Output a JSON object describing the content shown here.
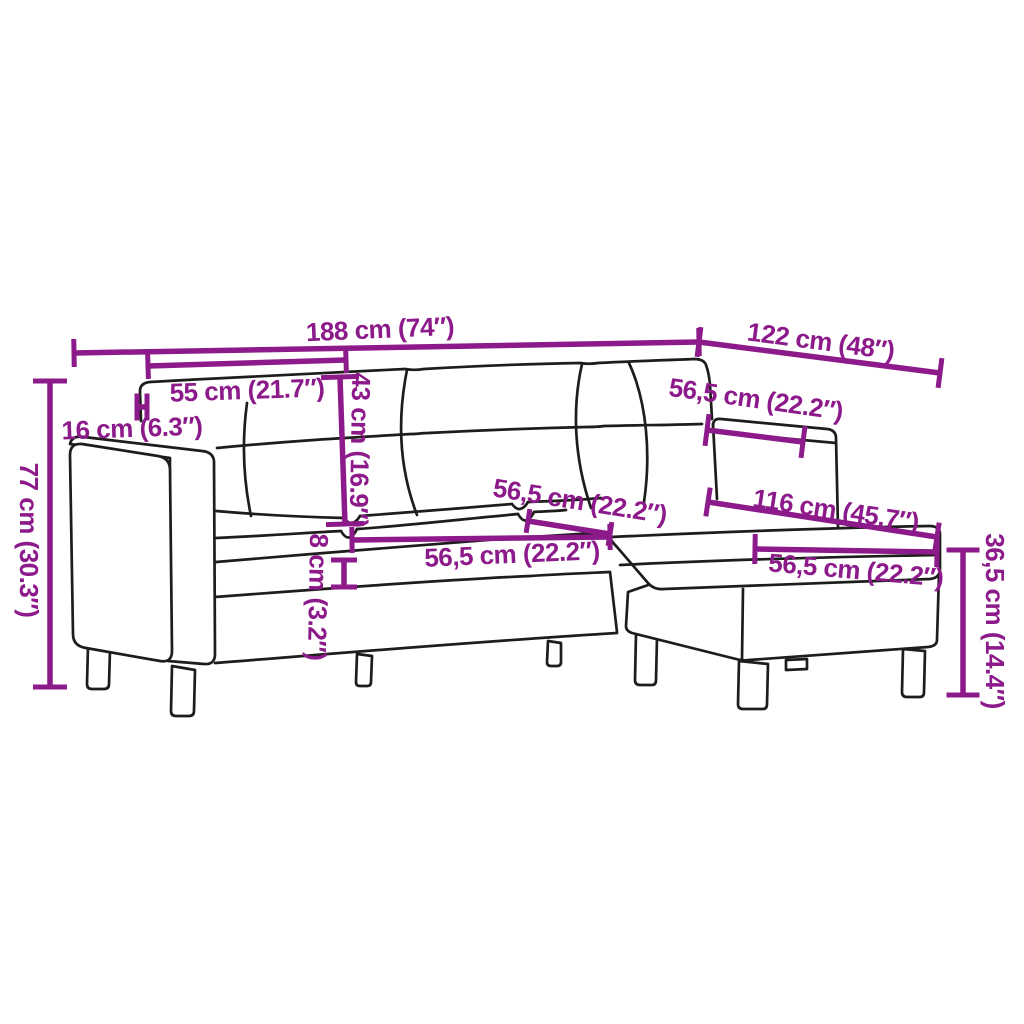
{
  "figure": {
    "type": "product-dimension-diagram",
    "subject": "sectional-sofa-with-footstool-line-drawing",
    "unit_primary": "cm",
    "unit_secondary": "inch",
    "font_size": 26
  },
  "colors": {
    "background": "#FFFFFF",
    "annotation": "#8C1A8A",
    "outline": "#1D1D1B"
  },
  "canvas": {
    "width": 1024,
    "height": 1024
  },
  "dimensions": [
    {
      "name": "overall-width",
      "label": "188 cm (74″)",
      "cm": "188",
      "inch": "74",
      "line": [
        74,
        353,
        699,
        342
      ],
      "tick": 28,
      "text": [
        380,
        329
      ],
      "rotate": -2.5
    },
    {
      "name": "overall-depth",
      "label": "122 cm (48″)",
      "cm": "122",
      "inch": "48",
      "line": [
        699,
        342,
        940,
        373
      ],
      "tick": 30,
      "text": [
        821,
        341
      ],
      "rotate": 7.5
    },
    {
      "name": "back-cushion-width",
      "label": "55 cm (21.7″)",
      "cm": "55",
      "inch": "21.7",
      "line": [
        148,
        366,
        346,
        360
      ],
      "tick": 26,
      "text": [
        247,
        390
      ],
      "rotate": -2
    },
    {
      "name": "backrest-height",
      "label": "43 cm (16.9″)",
      "cm": "43",
      "inch": "16.9",
      "line": [
        340,
        377,
        345,
        524
      ],
      "tick": 38,
      "text": [
        360,
        450
      ],
      "rotate": 91
    },
    {
      "name": "armrest-width",
      "label": "16 cm (6.3″)",
      "cm": "16",
      "inch": "6.3",
      "line": [
        137,
        407,
        147,
        407
      ],
      "tick": 27,
      "text": [
        132,
        428
      ],
      "rotate": -2
    },
    {
      "name": "overall-height",
      "label": "77 cm (30.3″)",
      "cm": "77",
      "inch": "30.3",
      "line": [
        50,
        381,
        50,
        687
      ],
      "tick": 34,
      "text": [
        29,
        540
      ],
      "rotate": 90
    },
    {
      "name": "right-backrest-width",
      "label": "56,5 cm (22.2″)",
      "cm": "56,5",
      "inch": "22.2",
      "line": [
        707,
        430,
        803,
        442
      ],
      "tick": 32,
      "text": [
        756,
        399
      ],
      "rotate": 8
    },
    {
      "name": "seat-depth",
      "label": "56,5 cm (22.2″)",
      "cm": "56,5",
      "inch": "22.2",
      "line": [
        528,
        521,
        610,
        534
      ],
      "tick": 24,
      "text": [
        580,
        501
      ],
      "rotate": 9
    },
    {
      "name": "seat-width",
      "label": "56,5 cm (22.2″)",
      "cm": "56,5",
      "inch": "22.2",
      "line": [
        352,
        540,
        610,
        537
      ],
      "tick": 26,
      "text": [
        512,
        554
      ],
      "rotate": -2.5
    },
    {
      "name": "seat-cushion-thickness",
      "label": "8 cm (3.2″)",
      "cm": "8",
      "inch": "3.2",
      "line": [
        344,
        560,
        344,
        587
      ],
      "tick": 26,
      "text": [
        318,
        597
      ],
      "rotate": 91
    },
    {
      "name": "footstool-length",
      "label": "116 cm (45.7″)",
      "cm": "116",
      "inch": "45.7",
      "line": [
        708,
        502,
        937,
        537
      ],
      "tick": 29,
      "text": [
        836,
        510
      ],
      "rotate": 8.5
    },
    {
      "name": "footstool-width",
      "label": "56,5 cm (22.2″)",
      "cm": "56,5",
      "inch": "22.2",
      "line": [
        755,
        549,
        937,
        552
      ],
      "tick": 30,
      "text": [
        856,
        570
      ],
      "rotate": 5
    },
    {
      "name": "footstool-height",
      "label": "36,5 cm (14.4″)",
      "cm": "36,5",
      "inch": "14.4",
      "line": [
        963,
        550,
        963,
        695
      ],
      "tick": 33,
      "text": [
        995,
        621
      ],
      "rotate": 90
    }
  ]
}
